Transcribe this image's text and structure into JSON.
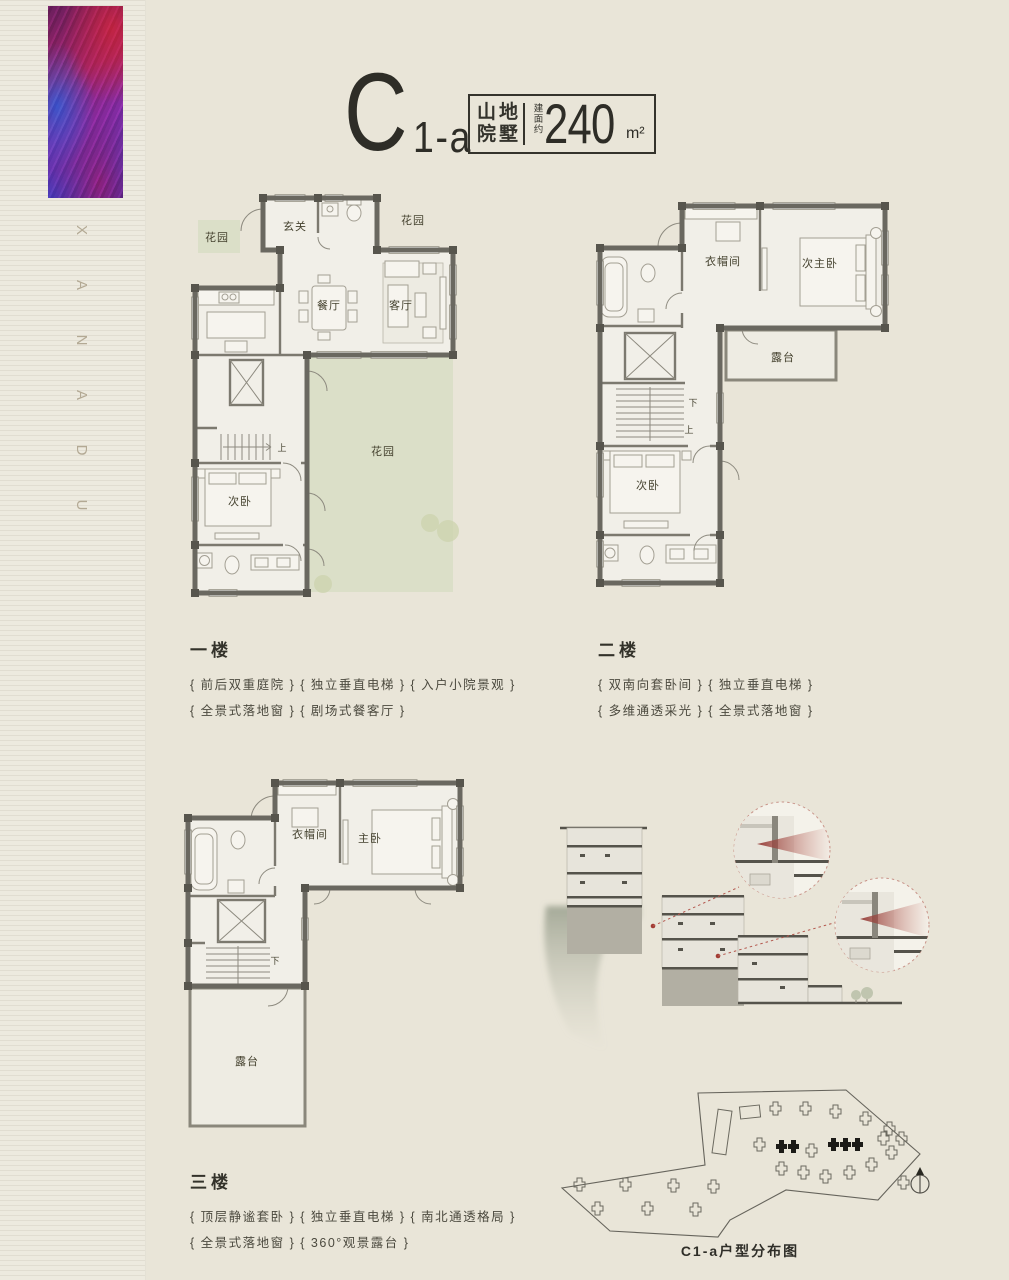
{
  "colors": {
    "background": "#e9e5d8",
    "sidebar_background": "#edeadf",
    "ink": "#2e2d27",
    "wall_gray": "#6a6860",
    "garden_green": "#dbdfc8",
    "accent_red": "#b4584e"
  },
  "sidebar": {
    "brand_letters": [
      "X",
      "A",
      "N",
      "A",
      "D",
      "U"
    ]
  },
  "header": {
    "unit_main": "C",
    "unit_sub": "1-a",
    "type_line1": "山地",
    "type_line2": "院墅",
    "area_label": "建面约",
    "area_value": "240",
    "area_unit": "m²"
  },
  "floors": [
    {
      "name": "一楼",
      "feature_line1": "{ 前后双重庭院 } { 独立垂直电梯 } { 入户小院景观 }",
      "feature_line2": "{ 全景式落地窗 } { 剧场式餐客厅 }",
      "labels": {
        "garden_left": "花园",
        "entry": "玄关",
        "garden_right": "花园",
        "dining": "餐厅",
        "living": "客厅",
        "stairs_up": "上",
        "bedroom": "次卧",
        "garden_main": "花园"
      }
    },
    {
      "name": "二楼",
      "feature_line1": "{ 双南向套卧间 } { 独立垂直电梯 }",
      "feature_line2": "{ 多维通透采光 } { 全景式落地窗 }",
      "labels": {
        "closet": "衣帽间",
        "second_master": "次主卧",
        "terrace": "露台",
        "stairs_down": "下",
        "stairs_up": "上",
        "bedroom": "次卧"
      }
    },
    {
      "name": "三楼",
      "feature_line1": "{ 顶层静谧套卧 } { 独立垂直电梯 } { 南北通透格局 }",
      "feature_line2": "{ 全景式落地窗 } { 360°观景露台 }",
      "labels": {
        "closet": "衣帽间",
        "master": "主卧",
        "stairs_down": "下",
        "terrace": "露台"
      }
    }
  ],
  "site_plan": {
    "caption": "C1-a户型分布图"
  }
}
